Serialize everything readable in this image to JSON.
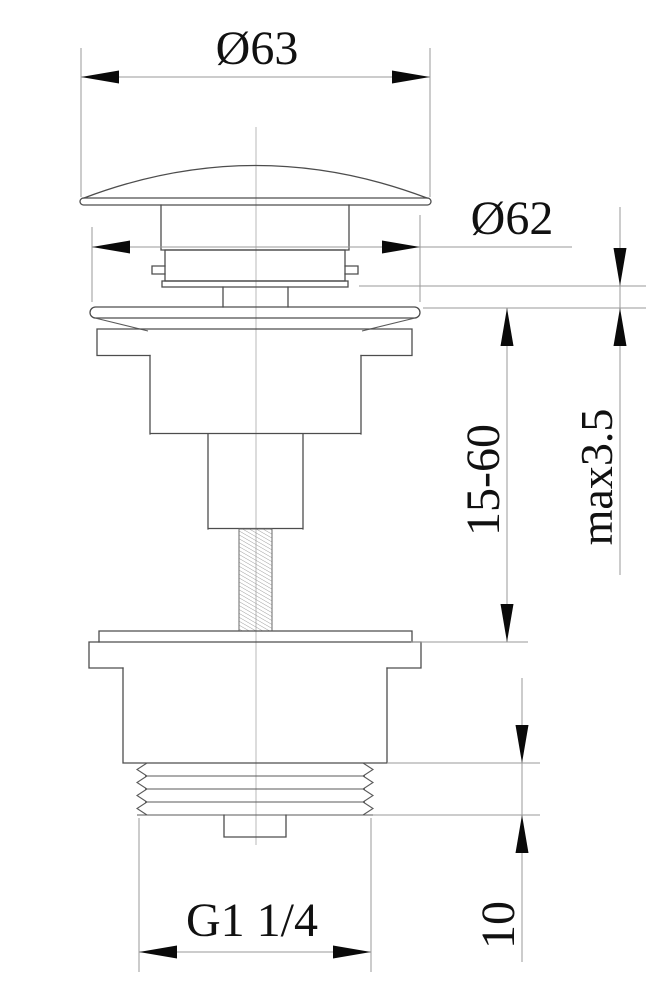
{
  "title": "Basin pop-up waste valve technical drawing",
  "colors": {
    "background": "#ffffff",
    "part_line": "#4d4d4d",
    "dimension_line": "#9a9a9a",
    "text": "#111111",
    "arrow": "#0a0a0a"
  },
  "dimensions": {
    "cap_diameter": {
      "label": "Ø63"
    },
    "flange_diameter": {
      "label": "Ø62"
    },
    "clamping_range": {
      "label": "15-60"
    },
    "max_thickness": {
      "label": "max3.5"
    },
    "thread_length": {
      "label": "10"
    },
    "thread_size": {
      "label": "G1 1/4"
    }
  }
}
